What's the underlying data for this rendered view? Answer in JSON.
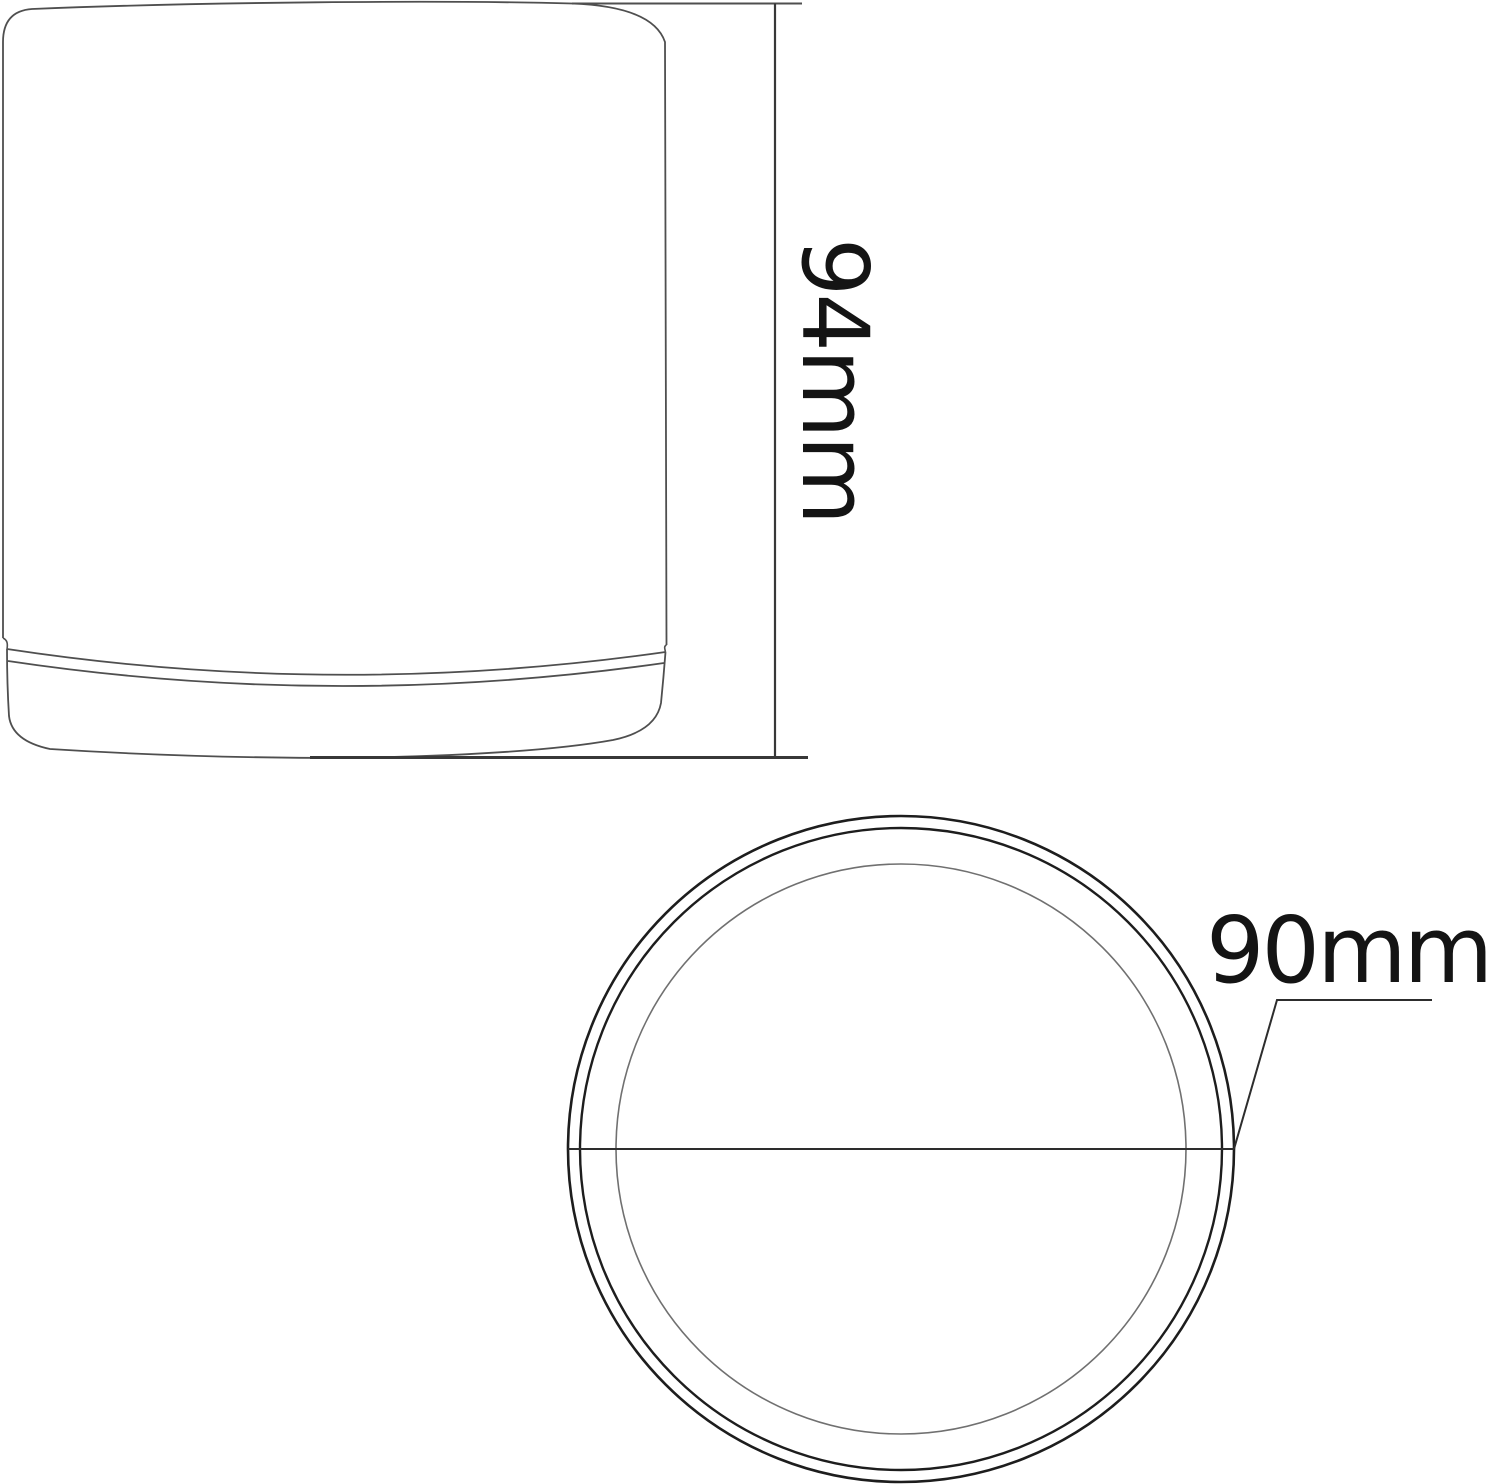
{
  "drawing": {
    "side_view": {
      "height_label": "94mm"
    },
    "top_view": {
      "diameter_label": "90mm"
    }
  },
  "colors": {
    "background": "#ffffff",
    "outline": "#4f4f4f",
    "rim_dark": "#1d1d1d",
    "inner_wall": "#707070",
    "dimension_line": "#383838",
    "label_text": "#141414"
  }
}
